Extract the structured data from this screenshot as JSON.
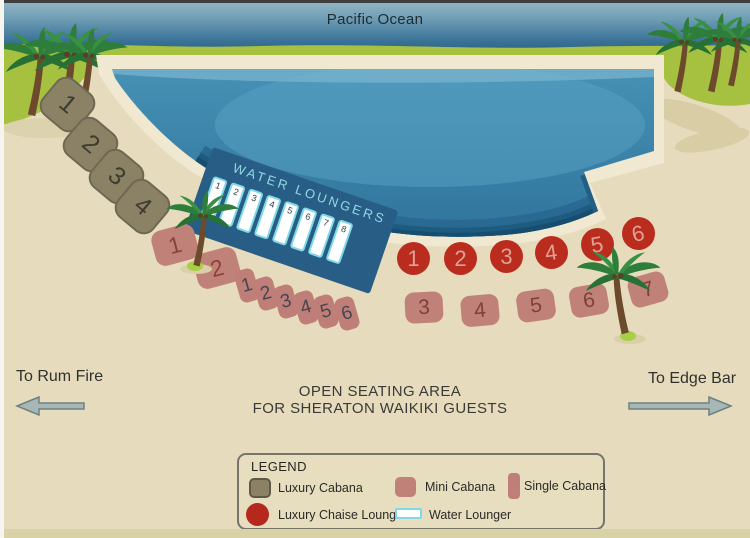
{
  "ocean": {
    "title": "Pacific Ocean"
  },
  "platform": {
    "label": "WATER LOUNGERS"
  },
  "seats": {
    "luxury_cabanas": [
      "1",
      "2",
      "3",
      "4"
    ],
    "mini_cabanas": [
      "1",
      "2",
      "3",
      "4",
      "5",
      "6",
      "7"
    ],
    "single_cabanas": [
      "1",
      "2",
      "3",
      "4",
      "5",
      "6"
    ],
    "chaise_lounges": [
      "1",
      "2",
      "3",
      "4",
      "5",
      "6"
    ],
    "water_loungers": [
      "1",
      "2",
      "3",
      "4",
      "5",
      "6",
      "7",
      "8"
    ]
  },
  "directions": {
    "left": "To Rum Fire",
    "right": "To Edge Bar"
  },
  "notice": {
    "line1": "OPEN SEATING AREA",
    "line2": "FOR SHERATON WAIKIKI GUESTS"
  },
  "legend": {
    "title": "LEGEND",
    "items": [
      {
        "label": "Luxury Cabana",
        "color": "#8b8266"
      },
      {
        "label": "Mini Cabana",
        "color": "#c08179"
      },
      {
        "label": "Single Cabana",
        "color": "#bf7f78"
      },
      {
        "label": "Luxury Chaise Lounge",
        "color": "#b5281e"
      },
      {
        "label": "Water Lounger",
        "color": "#7fd9e6"
      }
    ]
  },
  "colors": {
    "ocean_top": "#93b5c5",
    "ocean_bottom": "#2b6386",
    "grass": "#a6c13f",
    "sand": "#e6dcbd",
    "deck": "#f0e8d0",
    "pool_water": "#4791b5",
    "pool_deep": "#1e5b81",
    "platform": "#285d86",
    "platform_text": "#92d9e3",
    "luxury_cabana": "#8b8266",
    "mini_cabana": "#c08179",
    "chaise_lounge": "#ba2c1e",
    "arrow": "#a7b7b6"
  }
}
